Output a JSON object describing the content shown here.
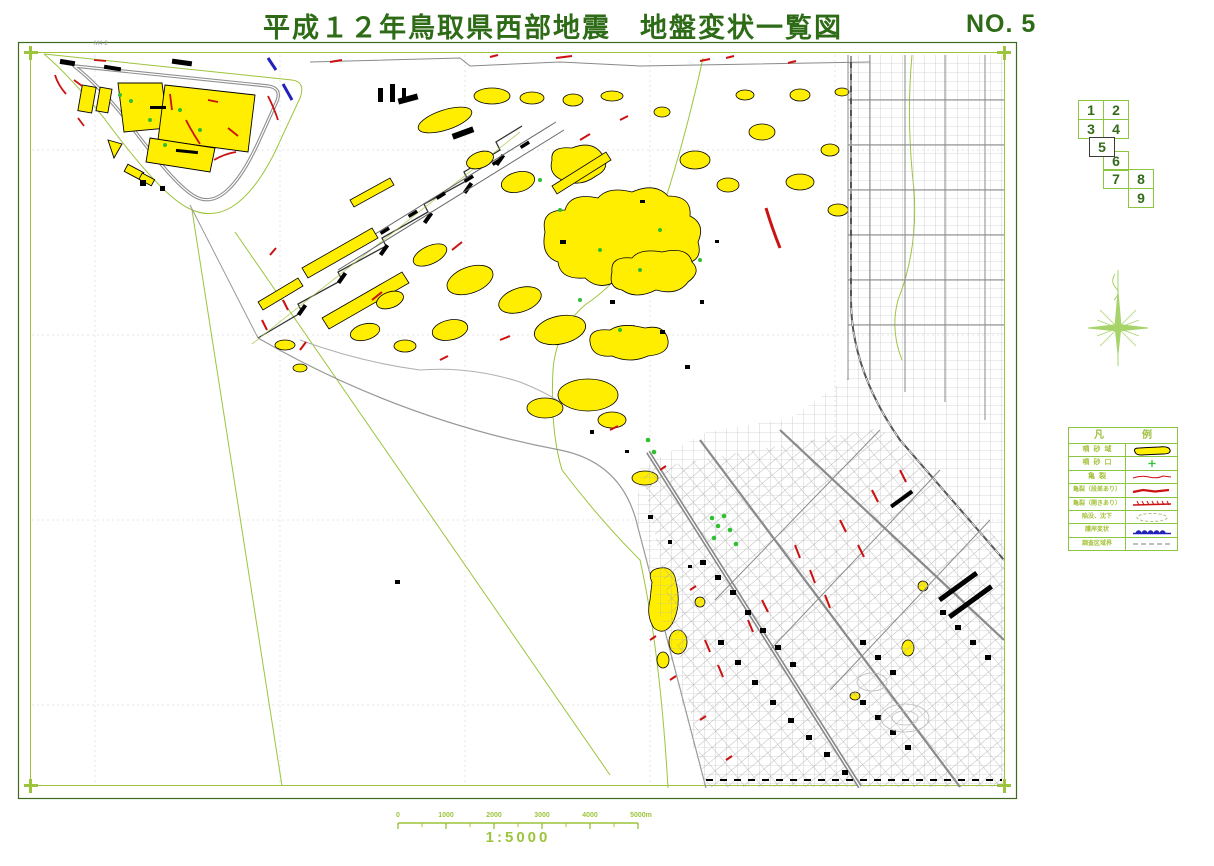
{
  "header": {
    "title": "平成１２年鳥取県西部地震　地盤変状一覧図",
    "sheet_no": "NO. 5"
  },
  "index_map": {
    "cells": [
      "1",
      "2",
      "3",
      "4",
      "5",
      "6",
      "7",
      "8",
      "9"
    ],
    "current": "5"
  },
  "legend": {
    "title": "凡　例",
    "rows": [
      {
        "label": "噴砂域",
        "symbol": "sand-boil-area"
      },
      {
        "label": "噴砂口",
        "symbol": "sand-boil-vent"
      },
      {
        "label": "亀裂",
        "symbol": "crack"
      },
      {
        "label": "亀裂（段差あり）",
        "symbol": "crack-with-step"
      },
      {
        "label": "亀裂（開きあり）",
        "symbol": "crack-with-opening"
      },
      {
        "label": "陥没、沈下",
        "symbol": "depression-subsidence"
      },
      {
        "label": "護岸変状",
        "symbol": "seawall-deformation"
      },
      {
        "label": "調査区域界",
        "symbol": "survey-area-boundary"
      }
    ]
  },
  "scale_bar": {
    "ticks": [
      "0",
      "1000",
      "2000",
      "3000",
      "4000",
      "5000m"
    ],
    "ratio": "1:5000"
  },
  "map_annotations": [
    "M4-2"
  ],
  "colors": {
    "title_green": "#2e6b17",
    "frame_dark_green": "#3f6b1f",
    "line_light_green": "#9cc43c",
    "sand_yellow": "#ffee00",
    "crack_red": "#cc1111",
    "seawall_blue": "#2222bb",
    "road_gray": "#999999",
    "building_black": "#000000"
  }
}
